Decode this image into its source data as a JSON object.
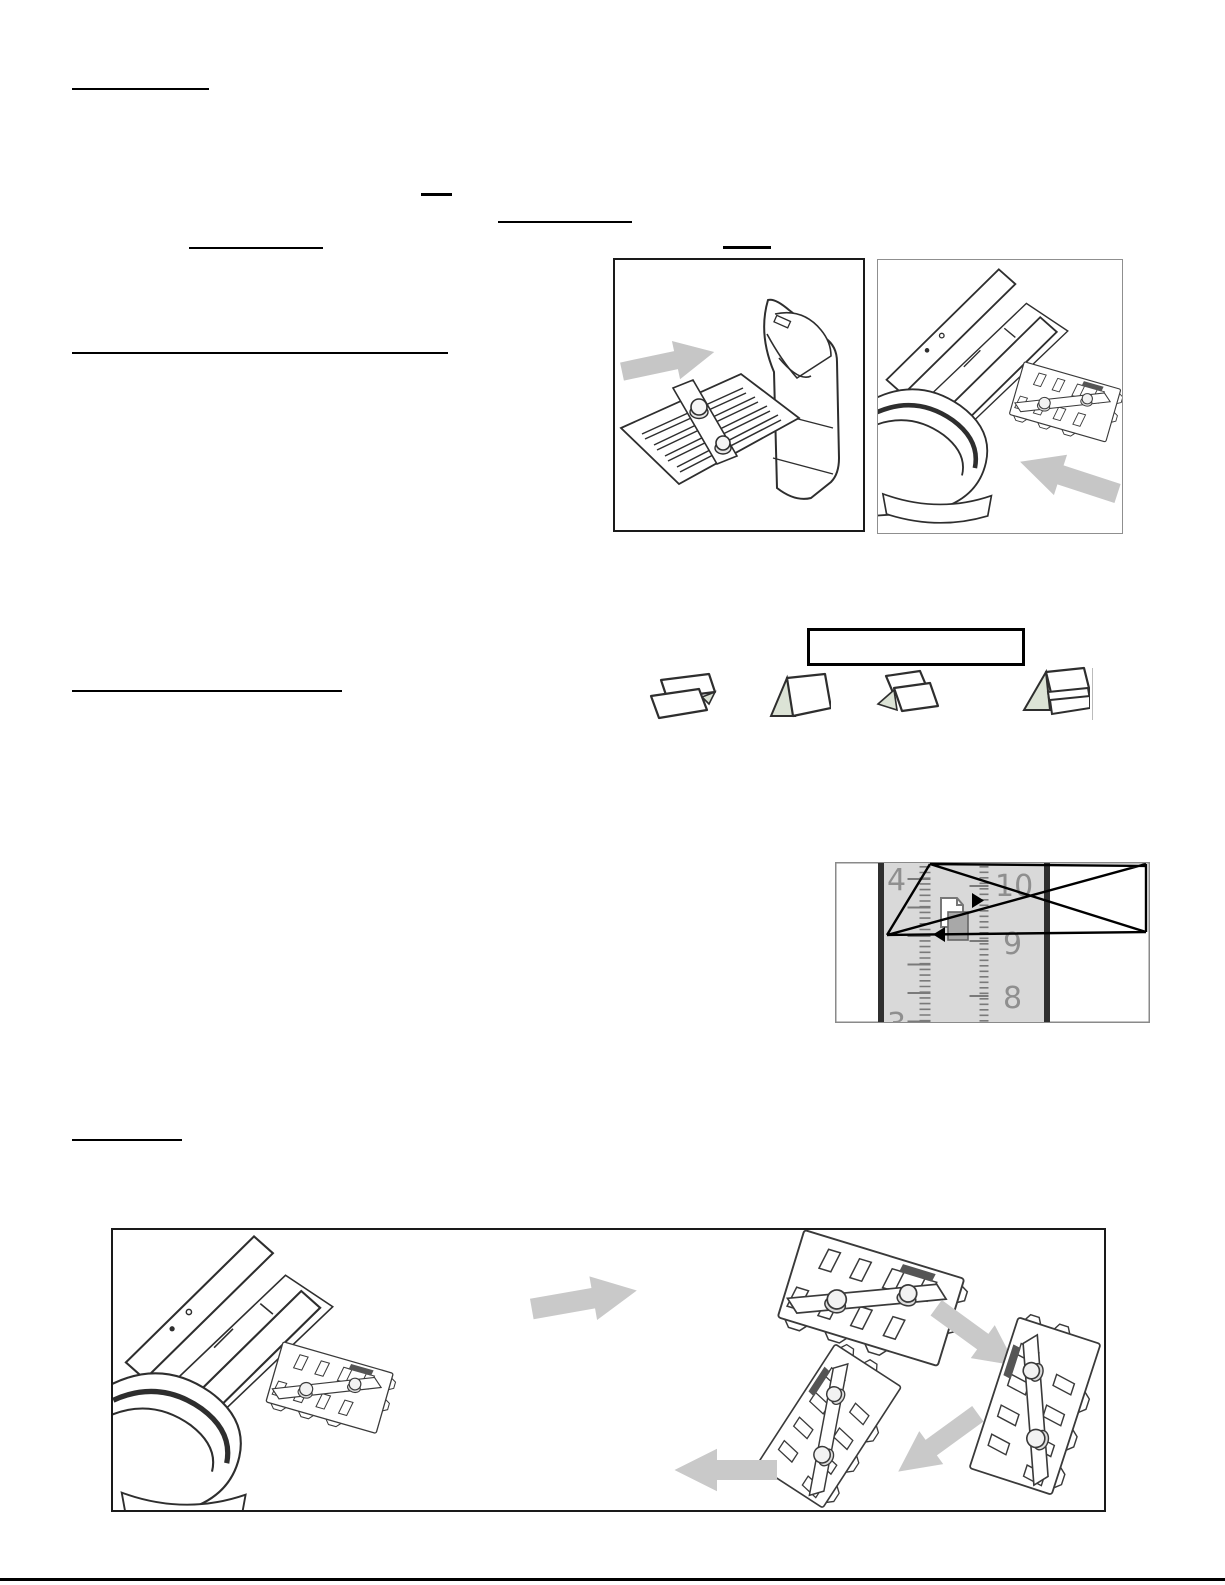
{
  "page": {
    "background": "#ffffff",
    "kind": "scanned-manual-page"
  },
  "rules": {
    "underline_color": "#000000",
    "footer_rule_color": "#000000"
  },
  "figures": {
    "outfeed_tray_figure": {
      "name": "folder-machine-outfeed-tray"
    },
    "fold_plate_removal_figure": {
      "name": "folder-machine-fold-plate-removal"
    },
    "fold_type_label_box": {
      "border_color": "#000000"
    },
    "fold_icons": [
      "z-fold-icon",
      "half-fold-icon",
      "letter-fold-icon",
      "double-parallel-fold-icon"
    ],
    "bottom_panel": {
      "name": "fold-plate-rotation-sequence"
    }
  },
  "ruler_detail": {
    "left_scale_labels": [
      "4",
      "3"
    ],
    "right_scale_labels": [
      "10",
      "9",
      "8"
    ],
    "strip_color": "#d9d9d9",
    "edge_bar_color": "#2f2f2f",
    "numeral_color": "#8f8f8f",
    "paper_icon_fill": "#a8a8a8",
    "marker_color": "#000000"
  },
  "colors": {
    "arrow_gray": "#c6c6c6",
    "line_art": "#2e2e2e",
    "fold_icon_accent": "#dce3d6",
    "icon_edge_line": "#bbbbbb"
  }
}
